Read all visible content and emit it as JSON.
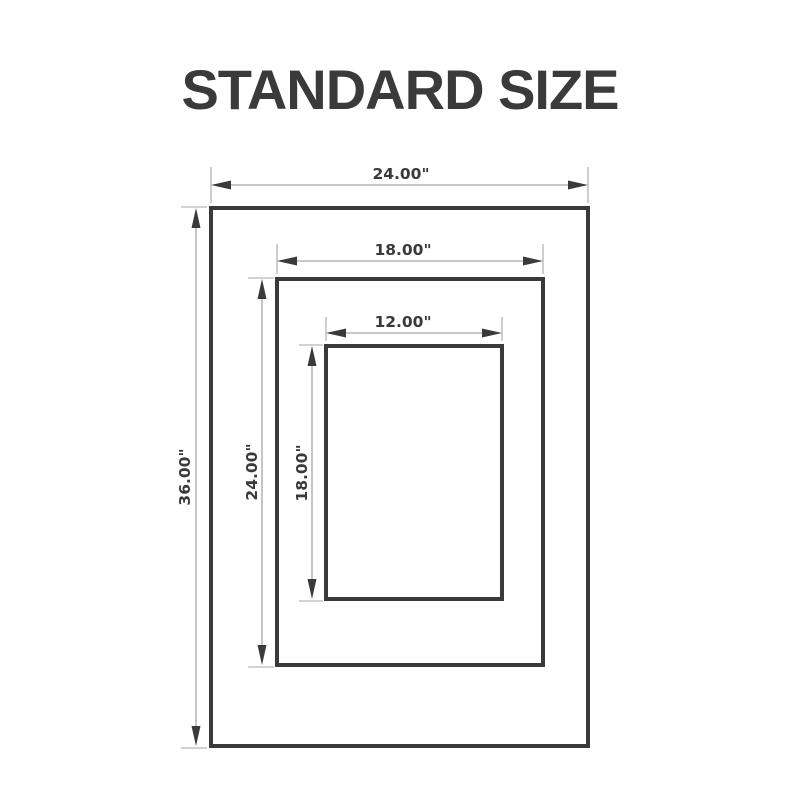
{
  "title": "STANDARD SIZE",
  "diagram": {
    "frames": [
      {
        "id": "outer-frame",
        "width_label": "24.00\"",
        "height_label": "36.00\""
      },
      {
        "id": "middle-frame",
        "width_label": "18.00\"",
        "height_label": "24.00\""
      },
      {
        "id": "inner-frame",
        "width_label": "12.00\"",
        "height_label": "18.00\""
      }
    ],
    "colors": {
      "frame_stroke": "#3a3a3c",
      "dimension_line": "#a6a6a6",
      "arrowhead": "#3a3a3c",
      "label_text": "#3a3a3c",
      "background": "#ffffff"
    }
  }
}
